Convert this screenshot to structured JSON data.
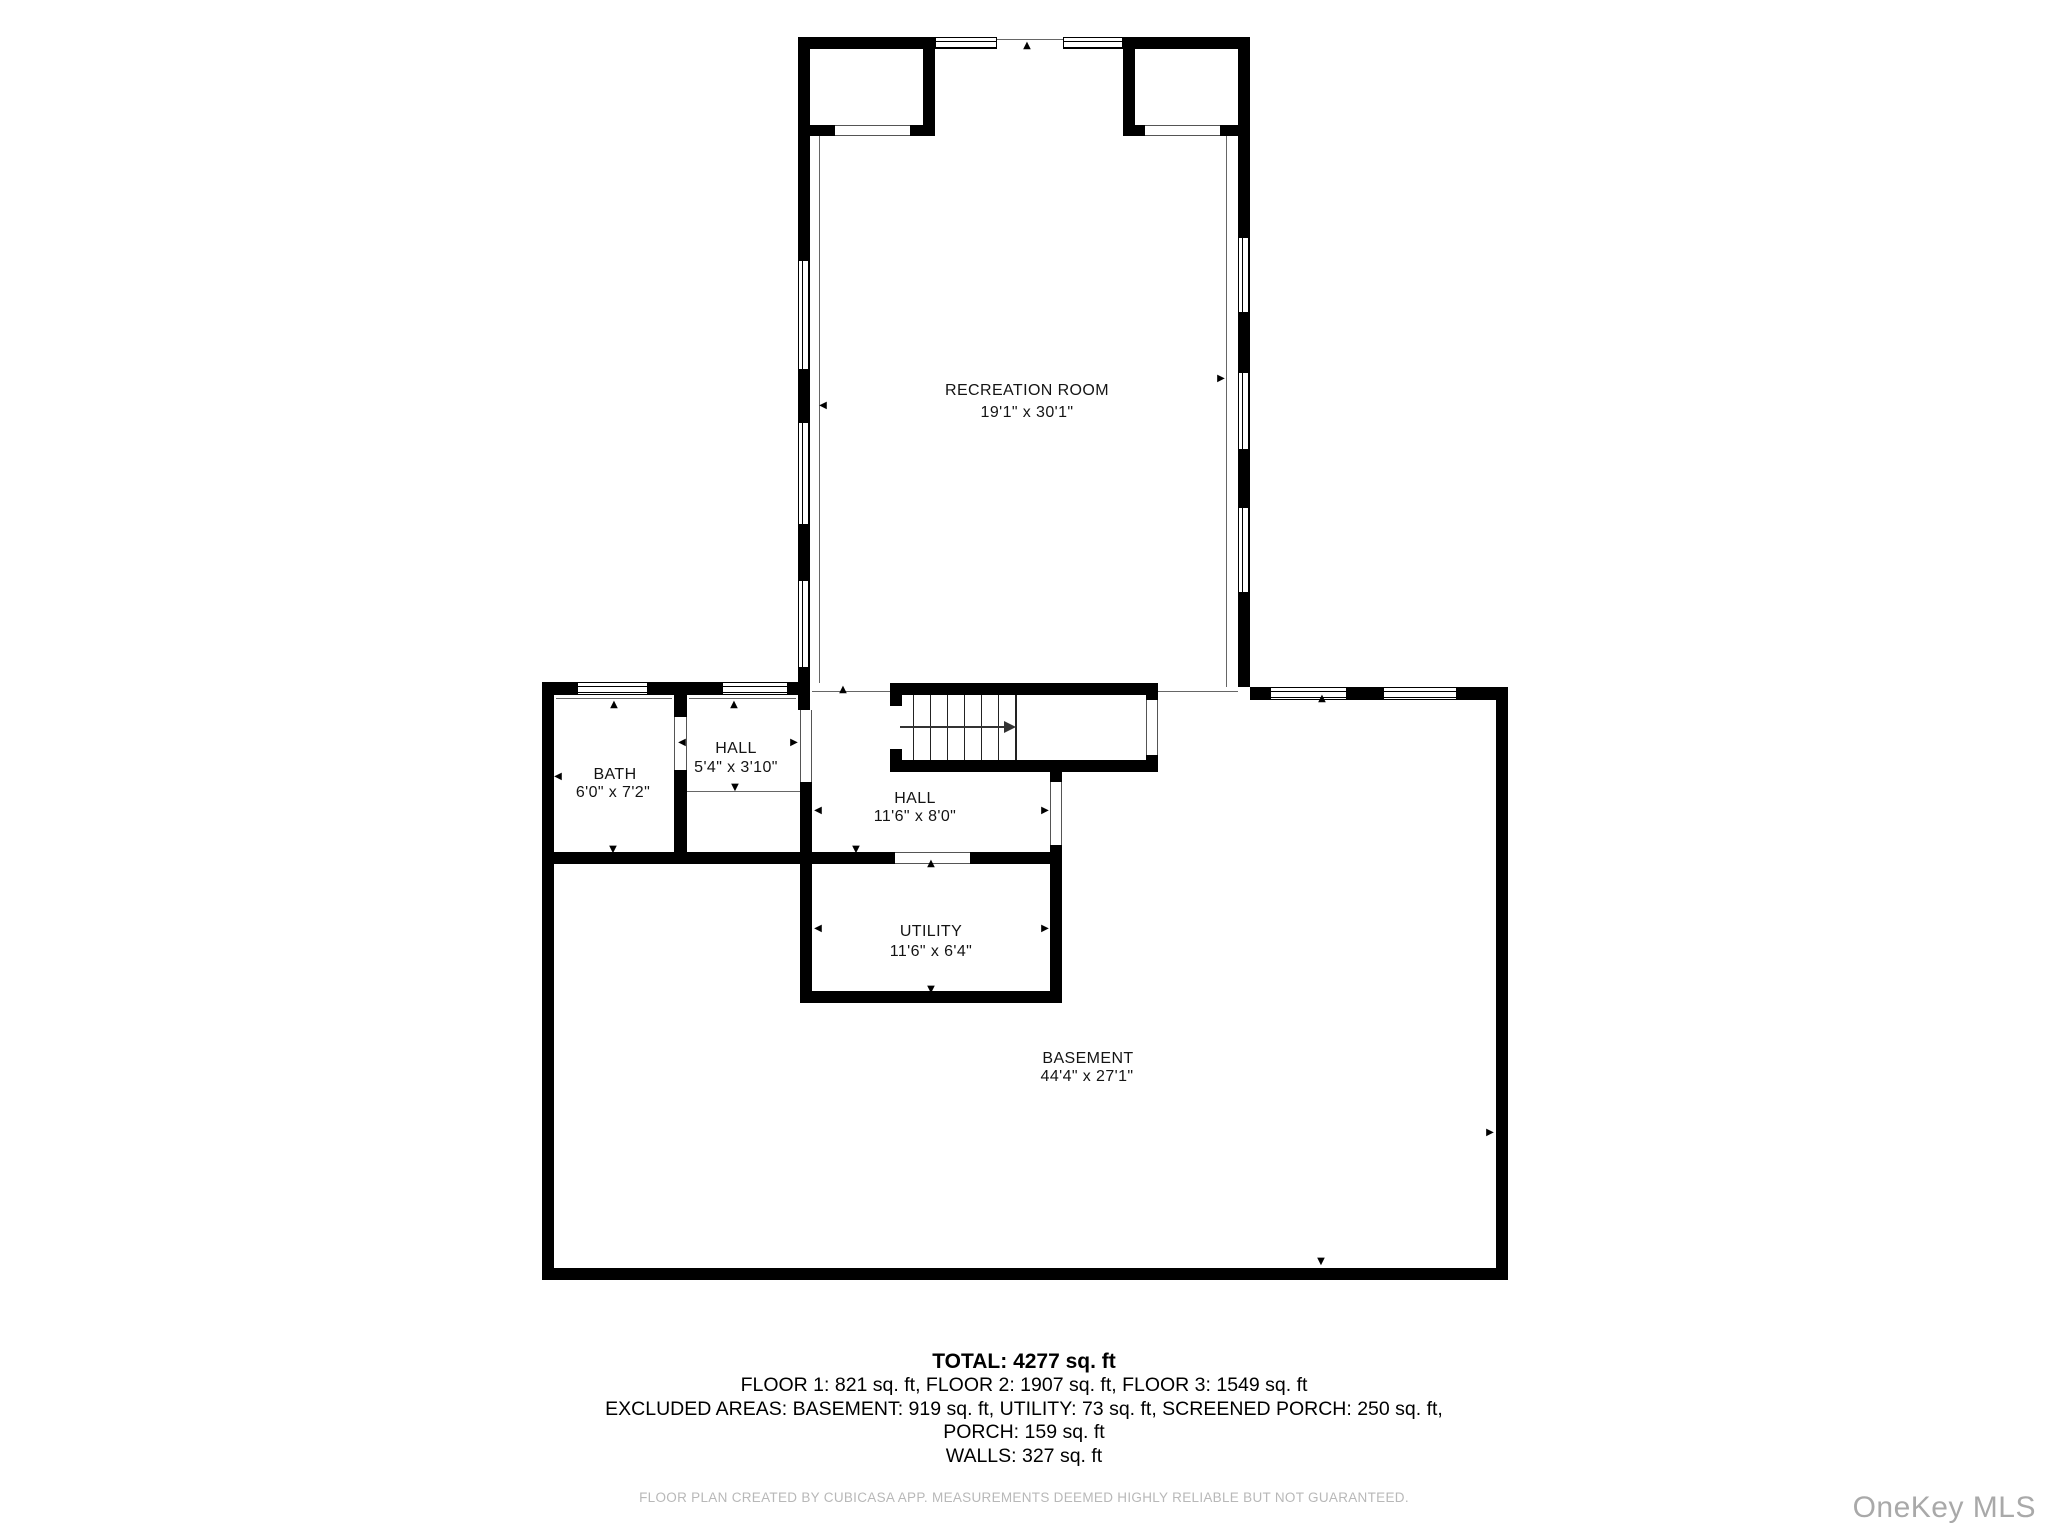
{
  "plan": {
    "rooms": [
      {
        "name": "RECREATION ROOM",
        "dims": "19'1\" x 30'1\""
      },
      {
        "name": "BATH",
        "dims": "6'0\" x 7'2\""
      },
      {
        "name": "HALL",
        "dims": "5'4\" x 3'10\""
      },
      {
        "name": "HALL",
        "dims": "11'6\" x 8'0\""
      },
      {
        "name": "UTILITY",
        "dims": "11'6\" x 6'4\""
      },
      {
        "name": "BASEMENT",
        "dims": "44'4\" x 27'1\""
      }
    ]
  },
  "summary": {
    "total": "TOTAL: 4277 sq. ft",
    "floors": "FLOOR 1: 821 sq. ft, FLOOR 2: 1907 sq. ft, FLOOR 3: 1549 sq. ft",
    "excluded": "EXCLUDED AREAS: BASEMENT: 919 sq. ft, UTILITY: 73 sq. ft, SCREENED PORCH: 250 sq. ft,",
    "porch": "PORCH: 159 sq. ft",
    "walls": "WALLS: 327 sq. ft"
  },
  "footer": {
    "disclaimer": "FLOOR PLAN CREATED BY CUBICASA APP. MEASUREMENTS DEEMED HIGHLY RELIABLE BUT NOT GUARANTEED.",
    "watermark": "OneKey MLS"
  },
  "icons": {
    "up": "▲",
    "down": "▼",
    "left": "◀",
    "right": "▶"
  },
  "colors": {
    "wall": "#000000",
    "text": "#141414",
    "muted": "#b8b8b8",
    "watermark": "#a9a9a9",
    "background": "#ffffff"
  }
}
